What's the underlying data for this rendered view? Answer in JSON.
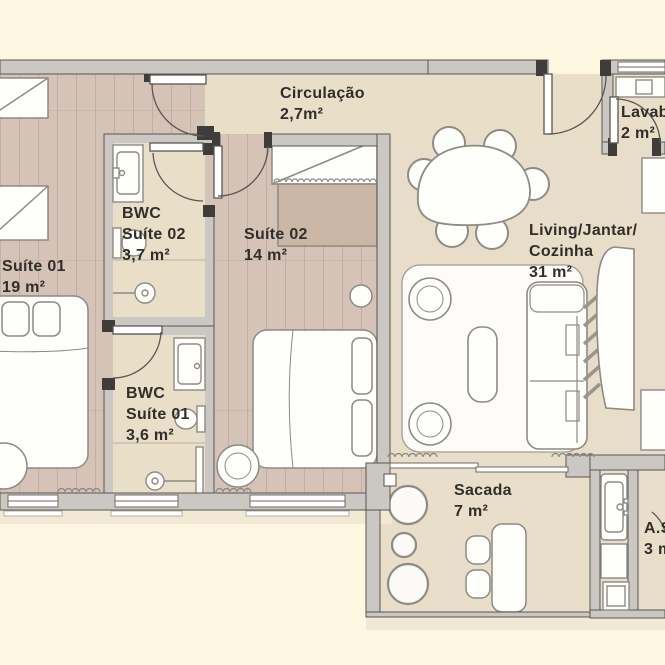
{
  "plan_title": "apartment-floor-plan",
  "rooms": {
    "circulacao": {
      "lines": [
        "Circulação"
      ],
      "area": "2,7m²"
    },
    "lavabo": {
      "lines": [
        "Lavabo"
      ],
      "area": "2 m²"
    },
    "suite01": {
      "lines": [
        "Suíte 01"
      ],
      "area": "19 m²"
    },
    "bwc_suite02": {
      "lines": [
        "BWC",
        "Suíte 02"
      ],
      "area": "3,7 m²"
    },
    "suite02": {
      "lines": [
        "Suíte 02"
      ],
      "area": "14 m²"
    },
    "living": {
      "lines": [
        "Living/Jantar/",
        "Cozinha"
      ],
      "area": "31 m²"
    },
    "bwc_suite01": {
      "lines": [
        "BWC",
        "Suíte 01"
      ],
      "area": "3,6 m²"
    },
    "sacada": {
      "lines": [
        "Sacada"
      ],
      "area": "7 m²"
    },
    "area_servico": {
      "lines": [
        "A.S."
      ],
      "area": "3 m²"
    }
  },
  "palette": {
    "background": "#fdf6e1",
    "wall": "#cbc8c3",
    "wall_outline": "#5a5651",
    "jamb": "#3f3d39",
    "wood_floor": "#d6c3b7",
    "tile_floor": "#e9dfc9",
    "living_tile": "#e7ddc8",
    "furniture_fill": "#fefefb",
    "furniture_outline": "#8e8a84",
    "dresser_tan": "#ccb6a6",
    "shadow": "#f1e9d4",
    "text": "#302e2a"
  }
}
